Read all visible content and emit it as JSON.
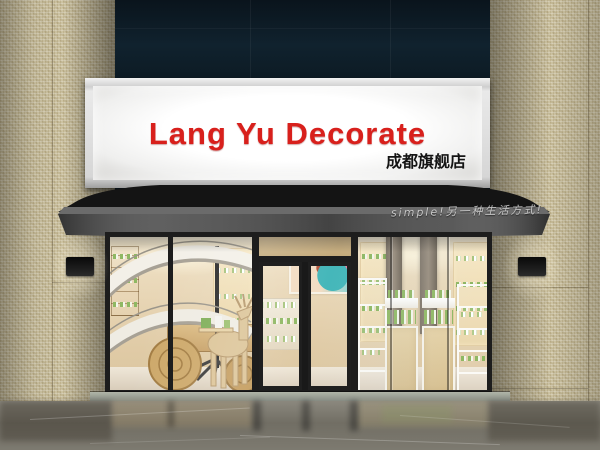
{
  "sign": {
    "brand": "Lang Yu Decorate",
    "branch": "成都旗舰店"
  },
  "awning": {
    "slogan": "simple!另一种生活方式!"
  },
  "colors": {
    "brand_red": "#d8201c",
    "sign_face": "#ffffff",
    "awning_dark": "#1c1c1c",
    "awning_skirt": "#5a5a5a",
    "stone_mosaic": "#cdc3a2",
    "upper_glass": "#10222e",
    "interior_warm": "#ead9ba",
    "wood": "#c9a36a",
    "product_green": "#8fb863",
    "frame_black": "#1d1d1d",
    "floor_marble": "#78746b"
  },
  "elements": [
    "lightbox-sign",
    "awning",
    "wall-sconce-left",
    "wall-sconce-right",
    "spiral-staircase",
    "deer-sculpture",
    "wooden-discs",
    "beauty-poster",
    "glass-double-door",
    "cosmetics-shelves",
    "display-cabinets",
    "marble-floor"
  ]
}
